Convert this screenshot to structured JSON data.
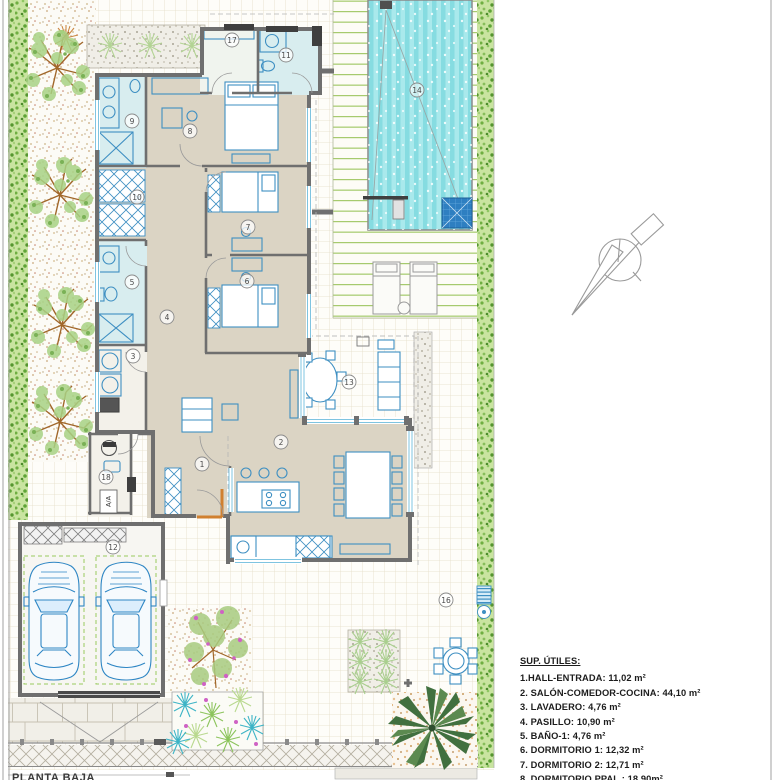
{
  "plan": {
    "sheet_title": "PLANTA BAJA",
    "labels": {
      "l1": "1",
      "l2": "2",
      "l3": "3",
      "l4": "4",
      "l5": "5",
      "l6": "6",
      "l7": "7",
      "l8": "8",
      "l9": "9",
      "l10": "10",
      "l11": "11",
      "l12": "12",
      "l13": "13",
      "l14": "14",
      "l16": "16",
      "l17": "17",
      "l18": "18",
      "aa": "A/A"
    }
  },
  "legend": {
    "title": "SUP. ÚTILES:",
    "items": [
      "1.HALL-ENTRADA: 11,02 m²",
      "2. SALÓN-COMEDOR-COCINA: 44,10 m²",
      "3. LAVADERO: 4,76 m²",
      "4. PASILLO: 10,90 m²",
      "5. BAÑO-1: 4,76 m²",
      "6. DORMITORIO 1: 12,32 m²",
      "7. DORMITORIO 2: 12,71 m²",
      "8. DORMITORIO PPAL.: 18,90m²"
    ]
  },
  "colors": {
    "wall": "#6f6f6f",
    "floor_main": "#dbd4c4",
    "floor_bath": "#d8edef",
    "furniture_line": "#3e8fc2",
    "pool_water": "#86dce1",
    "pool_steps": "#2e7fc1",
    "deck_line": "#9cc55e",
    "hedge": "#6fae41",
    "entry_door_accent": "#d08030"
  }
}
